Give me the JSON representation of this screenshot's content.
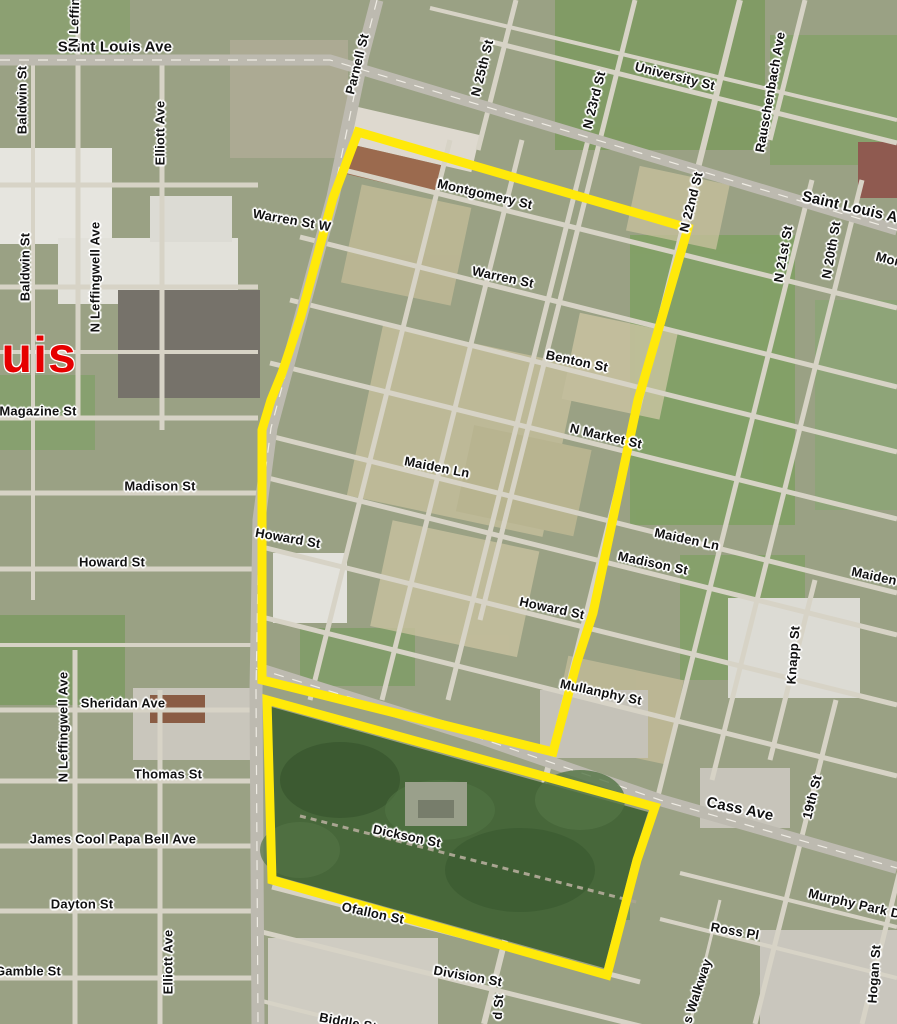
{
  "map": {
    "city_label": {
      "text": "ouis",
      "color": "#e60000"
    },
    "boundary": {
      "color": "#ffe90a",
      "stroke_width": 9,
      "upper_polygon": "358,132 688,228 638,400 593,613 577,662 553,752 262,680 262,430 271,400 282,373 301,316 333,198",
      "lower_polygon": "267,700 655,807 637,860 607,975 272,880"
    },
    "street_labels": [
      {
        "t": "Saint Louis Ave",
        "x": 115,
        "y": 47,
        "r": 0,
        "s": 15
      },
      {
        "t": "Saint Louis Ave",
        "x": 858,
        "y": 209,
        "r": 13,
        "s": 15
      },
      {
        "t": "University St",
        "x": 675,
        "y": 76,
        "r": 14
      },
      {
        "t": "Montgomery St",
        "x": 485,
        "y": 194,
        "r": 13
      },
      {
        "t": "Warren St W",
        "x": 292,
        "y": 220,
        "r": 10
      },
      {
        "t": "Warren St",
        "x": 503,
        "y": 277,
        "r": 12
      },
      {
        "t": "Benton St",
        "x": 577,
        "y": 361,
        "r": 12
      },
      {
        "t": "N Market St",
        "x": 606,
        "y": 436,
        "r": 13
      },
      {
        "t": "Maiden Ln",
        "x": 437,
        "y": 467,
        "r": 11
      },
      {
        "t": "Maiden Ln",
        "x": 687,
        "y": 539,
        "r": 12
      },
      {
        "t": "Maiden Ln",
        "x": 884,
        "y": 578,
        "r": 12
      },
      {
        "t": "Madison St",
        "x": 160,
        "y": 486,
        "r": 0
      },
      {
        "t": "Madison St",
        "x": 653,
        "y": 563,
        "r": 12
      },
      {
        "t": "Magazine St",
        "x": 38,
        "y": 411,
        "r": 0
      },
      {
        "t": "Howard St",
        "x": 112,
        "y": 562,
        "r": 0
      },
      {
        "t": "Howard St",
        "x": 288,
        "y": 538,
        "r": 10
      },
      {
        "t": "Howard St",
        "x": 552,
        "y": 608,
        "r": 12
      },
      {
        "t": "Mullanphy St",
        "x": 601,
        "y": 692,
        "r": 12
      },
      {
        "t": "Sheridan Ave",
        "x": 123,
        "y": 703,
        "r": 0
      },
      {
        "t": "Thomas St",
        "x": 168,
        "y": 774,
        "r": 0
      },
      {
        "t": "James Cool Papa Bell Ave",
        "x": 113,
        "y": 839,
        "r": 0
      },
      {
        "t": "Dayton St",
        "x": 82,
        "y": 904,
        "r": 0
      },
      {
        "t": "Gamble St",
        "x": 28,
        "y": 971,
        "r": 0
      },
      {
        "t": "Dickson St",
        "x": 407,
        "y": 836,
        "r": 12
      },
      {
        "t": "Ofallon St",
        "x": 373,
        "y": 913,
        "r": 12
      },
      {
        "t": "Division St",
        "x": 468,
        "y": 976,
        "r": 10
      },
      {
        "t": "Cass Ave",
        "x": 740,
        "y": 809,
        "r": 12,
        "s": 15
      },
      {
        "t": "Murphy Park Dr",
        "x": 857,
        "y": 904,
        "r": 13
      },
      {
        "t": "Ross Pl",
        "x": 735,
        "y": 931,
        "r": 10
      },
      {
        "t": "Biddle St",
        "x": 348,
        "y": 1022,
        "r": 10
      },
      {
        "t": "Mor",
        "x": 888,
        "y": 259,
        "r": 14
      },
      {
        "t": "N Leffingwell Ave",
        "x": 75,
        "y": -8,
        "r": -88
      },
      {
        "t": "Baldwin St",
        "x": 22,
        "y": 100,
        "r": -90
      },
      {
        "t": "Baldwin St",
        "x": 25,
        "y": 267,
        "r": -90
      },
      {
        "t": "Elliott Ave",
        "x": 160,
        "y": 133,
        "r": -90
      },
      {
        "t": "N Leffingwell Ave",
        "x": 95,
        "y": 277,
        "r": -90
      },
      {
        "t": "N Leffingwell Ave",
        "x": 63,
        "y": 727,
        "r": -90
      },
      {
        "t": "Elliott Ave",
        "x": 168,
        "y": 962,
        "r": -90
      },
      {
        "t": "Parnell St",
        "x": 357,
        "y": 64,
        "r": -76
      },
      {
        "t": "N 25th St",
        "x": 482,
        "y": 68,
        "r": -76
      },
      {
        "t": "N 23rd St",
        "x": 594,
        "y": 100,
        "r": -76
      },
      {
        "t": "Rauschenbach Ave",
        "x": 770,
        "y": 92,
        "r": -80
      },
      {
        "t": "N 22nd St",
        "x": 691,
        "y": 202,
        "r": -76
      },
      {
        "t": "N 21st St",
        "x": 783,
        "y": 254,
        "r": -80
      },
      {
        "t": "N 20th St",
        "x": 831,
        "y": 250,
        "r": -80
      },
      {
        "t": "Knapp St",
        "x": 793,
        "y": 655,
        "r": -86
      },
      {
        "t": "19th St",
        "x": 812,
        "y": 797,
        "r": -76
      },
      {
        "t": "Hogan St",
        "x": 874,
        "y": 974,
        "r": -86
      },
      {
        "t": "s Walkway",
        "x": 697,
        "y": 991,
        "r": -72
      },
      {
        "t": "d St",
        "x": 498,
        "y": 1007,
        "r": -86
      }
    ]
  }
}
